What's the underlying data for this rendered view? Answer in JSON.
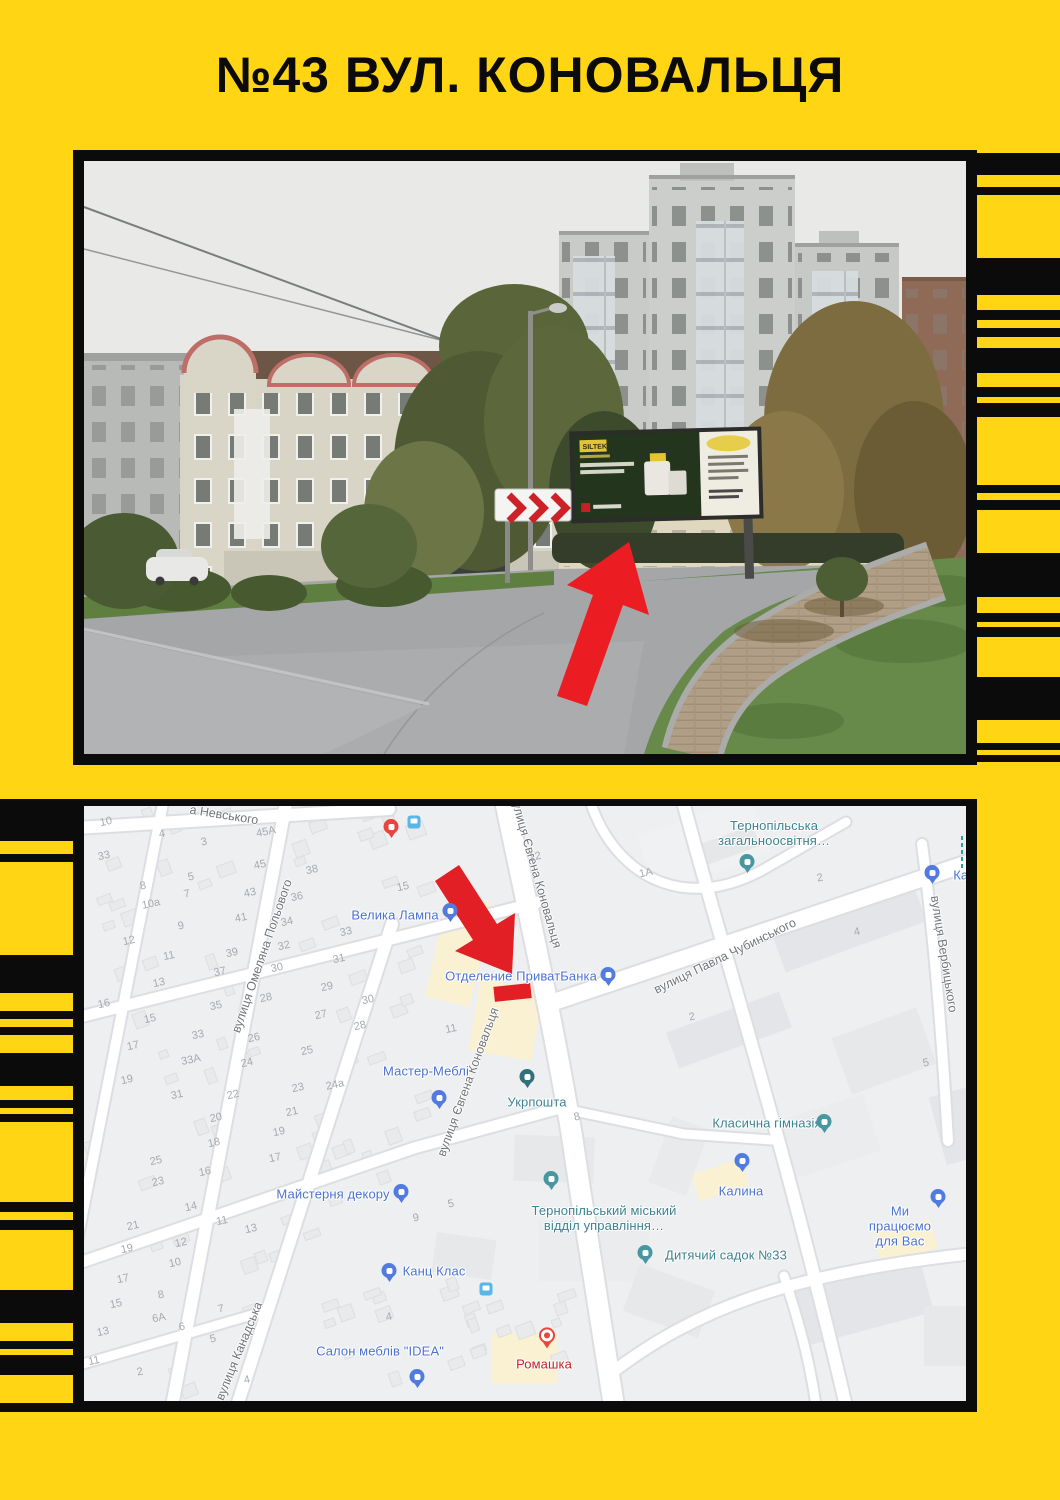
{
  "title": "№43 ВУЛ. КОНОВАЛЬЦЯ",
  "colors": {
    "yellow": "#FFD514",
    "black": "#0B0B0B",
    "arrow_red": "#EC1C23",
    "map_blue": "#4C72D2",
    "map_teal": "#3E8291",
    "map_red": "#C5221F"
  },
  "photo": {
    "billboard_brand": "SILTEK"
  },
  "map": {
    "streets": [
      {
        "label": "а Невського",
        "x": 140,
        "y": 9,
        "rot": 9
      },
      {
        "label": "вулиця Омеляна Польового",
        "x": 178,
        "y": 150,
        "rot": -71
      },
      {
        "label": "вулиця Євгена Коновальця",
        "x": 452,
        "y": 66,
        "rot": 74
      },
      {
        "label": "вулиця Євгена Коновальця",
        "x": 384,
        "y": 276,
        "rot": -70
      },
      {
        "label": "вулиця Павла Чубинського",
        "x": 641,
        "y": 150,
        "rot": -26
      },
      {
        "label": "вулиця Вербицького",
        "x": 860,
        "y": 148,
        "rot": 81
      },
      {
        "label": "вулиця Канадська",
        "x": 155,
        "y": 545,
        "rot": -68
      }
    ],
    "pois": [
      {
        "label": "Велика Лампа",
        "type": "shop",
        "lx": 311,
        "ly": 110,
        "px": 366,
        "py": 106
      },
      {
        "label": "Отделение ПриватБанка",
        "type": "bank",
        "lx": 437,
        "ly": 171,
        "px": 524,
        "py": 170
      },
      {
        "label": "Тернопільська\nзагальноосвітня…",
        "type": "school",
        "lx": 690,
        "ly": 28,
        "px": 663,
        "py": 57
      },
      {
        "label": "Кана",
        "type": "shop",
        "lx": 884,
        "ly": 70,
        "px": 848,
        "py": 68
      },
      {
        "label": "Мастер-Меблі",
        "type": "shop",
        "lx": 342,
        "ly": 266,
        "px": 355,
        "py": 293
      },
      {
        "label": "Укрпошта",
        "type": "post",
        "lx": 453,
        "ly": 297,
        "px": 443,
        "py": 272
      },
      {
        "label": "Майстерня декору",
        "type": "shop",
        "lx": 249,
        "ly": 389,
        "px": 317,
        "py": 387
      },
      {
        "label": "Канц Клас",
        "type": "shop",
        "lx": 350,
        "ly": 466,
        "px": 305,
        "py": 466
      },
      {
        "label": "Салон меблів \"IDEA\"",
        "type": "shop",
        "lx": 296,
        "ly": 546,
        "px": 333,
        "py": 572
      },
      {
        "label": "Ромашка",
        "type": "flower",
        "lx": 460,
        "ly": 559,
        "px": 463,
        "py": 531
      },
      {
        "label": "Класична гімназія",
        "type": "school",
        "lx": 683,
        "ly": 318,
        "px": 740,
        "py": 317
      },
      {
        "label": "Калина",
        "type": "shop",
        "lx": 657,
        "ly": 386,
        "px": 658,
        "py": 356
      },
      {
        "label": "Тернопільський міський\nвідділ управління…",
        "type": "civic",
        "lx": 520,
        "ly": 413,
        "px": 467,
        "py": 374
      },
      {
        "label": "Дитячий садок №33",
        "type": "kinder",
        "lx": 642,
        "ly": 450,
        "px": 561,
        "py": 448
      },
      {
        "label": "Ми працюємо для Вас",
        "type": "cart",
        "lx": 816,
        "ly": 421,
        "px": 854,
        "py": 392
      },
      {
        "label": "",
        "type": "red",
        "lx": 0,
        "ly": 0,
        "px": 307,
        "py": 22
      }
    ],
    "bus_icons": [
      {
        "x": 330,
        "y": 16
      },
      {
        "x": 402,
        "y": 483
      }
    ],
    "numbers": [
      {
        "t": "10",
        "x": 22,
        "y": 16
      },
      {
        "t": "4",
        "x": 78,
        "y": 28
      },
      {
        "t": "33",
        "x": 20,
        "y": 50
      },
      {
        "t": "3",
        "x": 120,
        "y": 36
      },
      {
        "t": "45А",
        "x": 182,
        "y": 26
      },
      {
        "t": "45",
        "x": 176,
        "y": 59
      },
      {
        "t": "5",
        "x": 107,
        "y": 71
      },
      {
        "t": "8",
        "x": 59,
        "y": 80
      },
      {
        "t": "7",
        "x": 103,
        "y": 88
      },
      {
        "t": "43",
        "x": 166,
        "y": 87
      },
      {
        "t": "38",
        "x": 228,
        "y": 64
      },
      {
        "t": "36",
        "x": 213,
        "y": 91
      },
      {
        "t": "10а",
        "x": 67,
        "y": 98
      },
      {
        "t": "41",
        "x": 157,
        "y": 112
      },
      {
        "t": "34",
        "x": 203,
        "y": 116
      },
      {
        "t": "9",
        "x": 97,
        "y": 120
      },
      {
        "t": "33",
        "x": 262,
        "y": 126
      },
      {
        "t": "12",
        "x": 45,
        "y": 135
      },
      {
        "t": "32",
        "x": 200,
        "y": 140
      },
      {
        "t": "11",
        "x": 85,
        "y": 150
      },
      {
        "t": "31",
        "x": 255,
        "y": 153
      },
      {
        "t": "39",
        "x": 148,
        "y": 147
      },
      {
        "t": "30",
        "x": 193,
        "y": 162
      },
      {
        "t": "37",
        "x": 136,
        "y": 166
      },
      {
        "t": "15",
        "x": 319,
        "y": 81
      },
      {
        "t": "29",
        "x": 243,
        "y": 181
      },
      {
        "t": "13",
        "x": 75,
        "y": 177
      },
      {
        "t": "28",
        "x": 182,
        "y": 192
      },
      {
        "t": "30",
        "x": 284,
        "y": 194
      },
      {
        "t": "16",
        "x": 20,
        "y": 198
      },
      {
        "t": "35",
        "x": 132,
        "y": 200
      },
      {
        "t": "27",
        "x": 237,
        "y": 209
      },
      {
        "t": "15",
        "x": 66,
        "y": 213
      },
      {
        "t": "28",
        "x": 276,
        "y": 220
      },
      {
        "t": "33",
        "x": 114,
        "y": 229
      },
      {
        "t": "17",
        "x": 49,
        "y": 240
      },
      {
        "t": "26",
        "x": 170,
        "y": 232
      },
      {
        "t": "25",
        "x": 223,
        "y": 245
      },
      {
        "t": "33А",
        "x": 107,
        "y": 254
      },
      {
        "t": "24",
        "x": 163,
        "y": 257
      },
      {
        "t": "24а",
        "x": 251,
        "y": 279
      },
      {
        "t": "19",
        "x": 43,
        "y": 274
      },
      {
        "t": "23",
        "x": 214,
        "y": 282
      },
      {
        "t": "31",
        "x": 93,
        "y": 289
      },
      {
        "t": "22",
        "x": 149,
        "y": 289
      },
      {
        "t": "21",
        "x": 208,
        "y": 306
      },
      {
        "t": "12",
        "x": 451,
        "y": 51
      },
      {
        "t": "1А",
        "x": 562,
        "y": 67
      },
      {
        "t": "4",
        "x": 773,
        "y": 126
      },
      {
        "t": "2",
        "x": 608,
        "y": 211
      },
      {
        "t": "5",
        "x": 842,
        "y": 257
      },
      {
        "t": "11",
        "x": 367,
        "y": 223
      },
      {
        "t": "8",
        "x": 493,
        "y": 311
      },
      {
        "t": "2",
        "x": 736,
        "y": 72
      },
      {
        "t": "20",
        "x": 132,
        "y": 312
      },
      {
        "t": "19",
        "x": 195,
        "y": 326
      },
      {
        "t": "18",
        "x": 130,
        "y": 337
      },
      {
        "t": "17",
        "x": 191,
        "y": 352
      },
      {
        "t": "25",
        "x": 72,
        "y": 355
      },
      {
        "t": "16",
        "x": 121,
        "y": 366
      },
      {
        "t": "23",
        "x": 74,
        "y": 376
      },
      {
        "t": "14",
        "x": 107,
        "y": 401
      },
      {
        "t": "11",
        "x": 138,
        "y": 415
      },
      {
        "t": "13",
        "x": 167,
        "y": 423
      },
      {
        "t": "21",
        "x": 49,
        "y": 420
      },
      {
        "t": "12",
        "x": 97,
        "y": 437
      },
      {
        "t": "19",
        "x": 43,
        "y": 443
      },
      {
        "t": "10",
        "x": 91,
        "y": 457
      },
      {
        "t": "17",
        "x": 39,
        "y": 473
      },
      {
        "t": "8",
        "x": 77,
        "y": 489
      },
      {
        "t": "15",
        "x": 32,
        "y": 498
      },
      {
        "t": "6А",
        "x": 75,
        "y": 512
      },
      {
        "t": "6",
        "x": 98,
        "y": 521
      },
      {
        "t": "7",
        "x": 137,
        "y": 503
      },
      {
        "t": "5",
        "x": 129,
        "y": 533
      },
      {
        "t": "13",
        "x": 19,
        "y": 526
      },
      {
        "t": "11",
        "x": 10,
        "y": 555
      },
      {
        "t": "2",
        "x": 56,
        "y": 566
      },
      {
        "t": "4",
        "x": 163,
        "y": 574
      },
      {
        "t": "9",
        "x": 332,
        "y": 412
      },
      {
        "t": "5",
        "x": 367,
        "y": 398
      },
      {
        "t": "4",
        "x": 305,
        "y": 511
      }
    ]
  },
  "stripes": {
    "right": [
      {
        "c": "k",
        "h": 22
      },
      {
        "c": "y",
        "h": 12
      },
      {
        "c": "k",
        "h": 8
      },
      {
        "c": "y",
        "h": 63
      },
      {
        "c": "k",
        "h": 37
      },
      {
        "c": "y",
        "h": 15
      },
      {
        "c": "k",
        "h": 10
      },
      {
        "c": "y",
        "h": 8
      },
      {
        "c": "k",
        "h": 9
      },
      {
        "c": "y",
        "h": 11
      },
      {
        "c": "k",
        "h": 25
      },
      {
        "c": "y",
        "h": 14
      },
      {
        "c": "k",
        "h": 10
      },
      {
        "c": "y",
        "h": 6
      },
      {
        "c": "k",
        "h": 14
      },
      {
        "c": "y",
        "h": 68
      },
      {
        "c": "k",
        "h": 8
      },
      {
        "c": "y",
        "h": 7
      },
      {
        "c": "k",
        "h": 10
      },
      {
        "c": "y",
        "h": 43
      },
      {
        "c": "k",
        "h": 44
      },
      {
        "c": "y",
        "h": 16
      },
      {
        "c": "k",
        "h": 9
      },
      {
        "c": "y",
        "h": 5
      },
      {
        "c": "k",
        "h": 10
      },
      {
        "c": "y",
        "h": 40
      },
      {
        "c": "k",
        "h": 43
      },
      {
        "c": "y",
        "h": 23
      },
      {
        "c": "k",
        "h": 7
      },
      {
        "c": "y",
        "h": 5
      },
      {
        "c": "k",
        "h": 7
      }
    ],
    "left": [
      {
        "c": "k",
        "h": 42
      },
      {
        "c": "y",
        "h": 13
      },
      {
        "c": "k",
        "h": 8
      },
      {
        "c": "y",
        "h": 93
      },
      {
        "c": "k",
        "h": 38
      },
      {
        "c": "y",
        "h": 18
      },
      {
        "c": "k",
        "h": 8
      },
      {
        "c": "y",
        "h": 8
      },
      {
        "c": "k",
        "h": 8
      },
      {
        "c": "y",
        "h": 18
      },
      {
        "c": "k",
        "h": 33
      },
      {
        "c": "y",
        "h": 14
      },
      {
        "c": "k",
        "h": 8
      },
      {
        "c": "y",
        "h": 6
      },
      {
        "c": "k",
        "h": 8
      },
      {
        "c": "y",
        "h": 80
      },
      {
        "c": "k",
        "h": 10
      },
      {
        "c": "y",
        "h": 8
      },
      {
        "c": "k",
        "h": 10
      },
      {
        "c": "y",
        "h": 60
      },
      {
        "c": "k",
        "h": 33
      },
      {
        "c": "y",
        "h": 18
      },
      {
        "c": "k",
        "h": 8
      },
      {
        "c": "y",
        "h": 6
      },
      {
        "c": "k",
        "h": 20
      },
      {
        "c": "y",
        "h": 28
      },
      {
        "c": "k",
        "h": 12
      }
    ]
  }
}
